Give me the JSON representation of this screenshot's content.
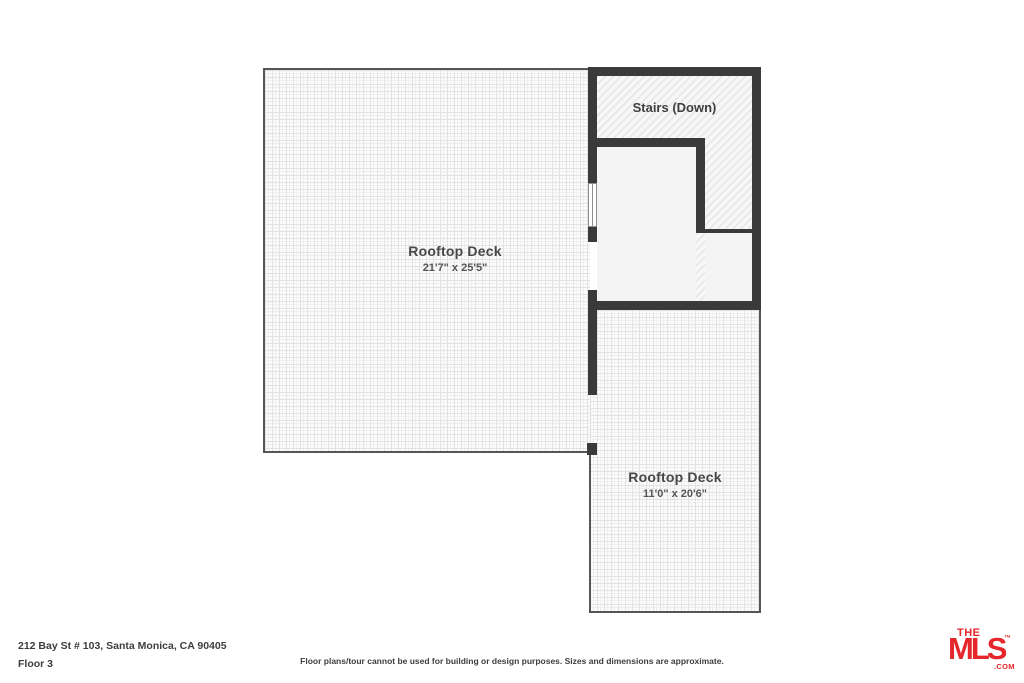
{
  "floorplan": {
    "main_deck": {
      "label": "Rooftop Deck",
      "dimensions": "21'7\" x 25'5\""
    },
    "stairs": {
      "label": "Stairs (Down)"
    },
    "small_deck": {
      "label": "Rooftop Deck",
      "dimensions": "11'0\" x 20'6\""
    }
  },
  "footer": {
    "address": "212 Bay St # 103, Santa Monica, CA 90405",
    "floor_label": "Floor 3",
    "disclaimer": "Floor plans/tour cannot be used for building or design purposes. Sizes and dimensions are approximate."
  },
  "logo": {
    "the": "THE",
    "mls": "MLS",
    "trademark": "™",
    "com": ".COM"
  },
  "colors": {
    "wall": "#3a3a3a",
    "deck_border": "#565656",
    "room_fill": "#f4f4f4",
    "text": "#474747",
    "logo_red": "#e5262b",
    "background": "#ffffff"
  }
}
